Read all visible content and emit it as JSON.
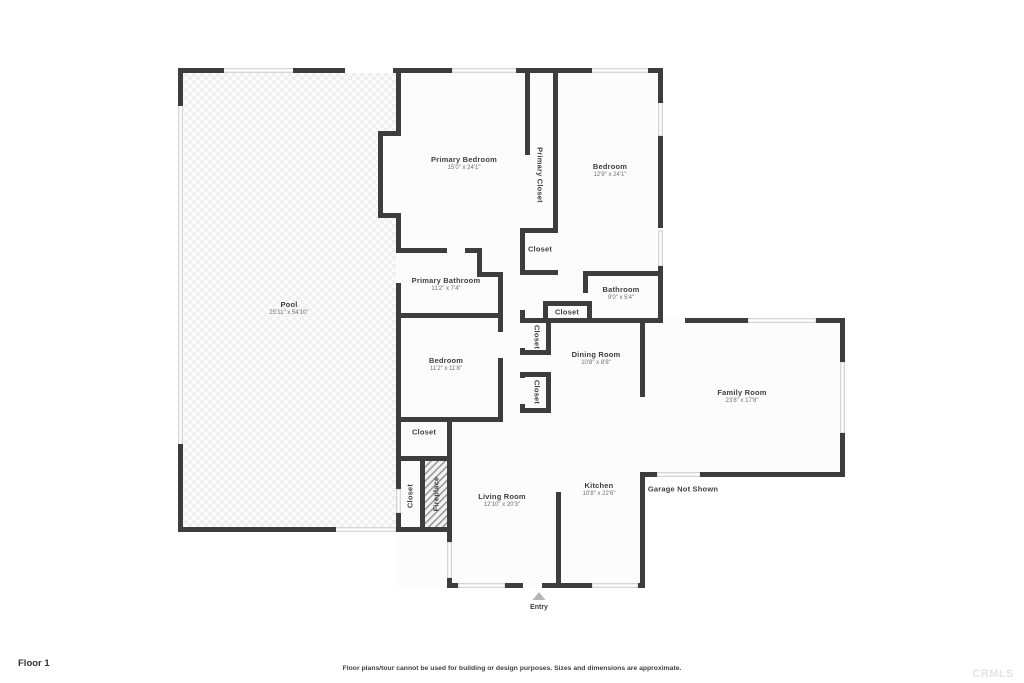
{
  "page": {
    "floor_label": "Floor 1",
    "disclaimer": "Floor plans/tour cannot be used for building or design purposes. Sizes and dimensions are approximate.",
    "watermark": "CRMLS"
  },
  "colors": {
    "wall": "#3d3d3d",
    "window": "#c2c2c2",
    "room_fill": "#fcfcfc",
    "pool_texture": "#f0f0f0",
    "label_text": "#3f3f3f",
    "dims_text": "#6e6e6e",
    "entry_marker": "#b5b5b5",
    "watermark_text": "#e4e4e4"
  },
  "rooms": {
    "pool": {
      "name": "Pool",
      "dims": "25'11\" x 54'10\""
    },
    "primary_bedroom": {
      "name": "Primary Bedroom",
      "dims": "15'0\" x 24'1\""
    },
    "primary_closet": {
      "name": "Primary Closet"
    },
    "bedroom_upper": {
      "name": "Bedroom",
      "dims": "12'9\" x 24'1\""
    },
    "closet_primary_hall": {
      "name": "Closet"
    },
    "primary_bathroom": {
      "name": "Primary Bathroom",
      "dims": "11'2\" x 7'4\""
    },
    "bathroom": {
      "name": "Bathroom",
      "dims": "9'0\" x 5'4\""
    },
    "closet_hall_top": {
      "name": "Closet"
    },
    "closet_hall_mid": {
      "name": "Closet"
    },
    "closet_hall_lower": {
      "name": "Closet"
    },
    "dining_room": {
      "name": "Dining Room",
      "dims": "10'8\" x 8'8\""
    },
    "family_room": {
      "name": "Family Room",
      "dims": "23'8\" x 17'8\""
    },
    "bedroom_middle": {
      "name": "Bedroom",
      "dims": "11'2\" x 11'8\""
    },
    "closet_bedroom": {
      "name": "Closet"
    },
    "closet_entry": {
      "name": "Closet"
    },
    "fireplace": {
      "name": "Fireplace"
    },
    "living_room": {
      "name": "Living Room",
      "dims": "12'10\" x 20'3\""
    },
    "kitchen": {
      "name": "Kitchen",
      "dims": "10'8\" x 22'6\""
    },
    "garage": {
      "name": "Garage Not Shown"
    },
    "entry": {
      "name": "Entry"
    }
  }
}
